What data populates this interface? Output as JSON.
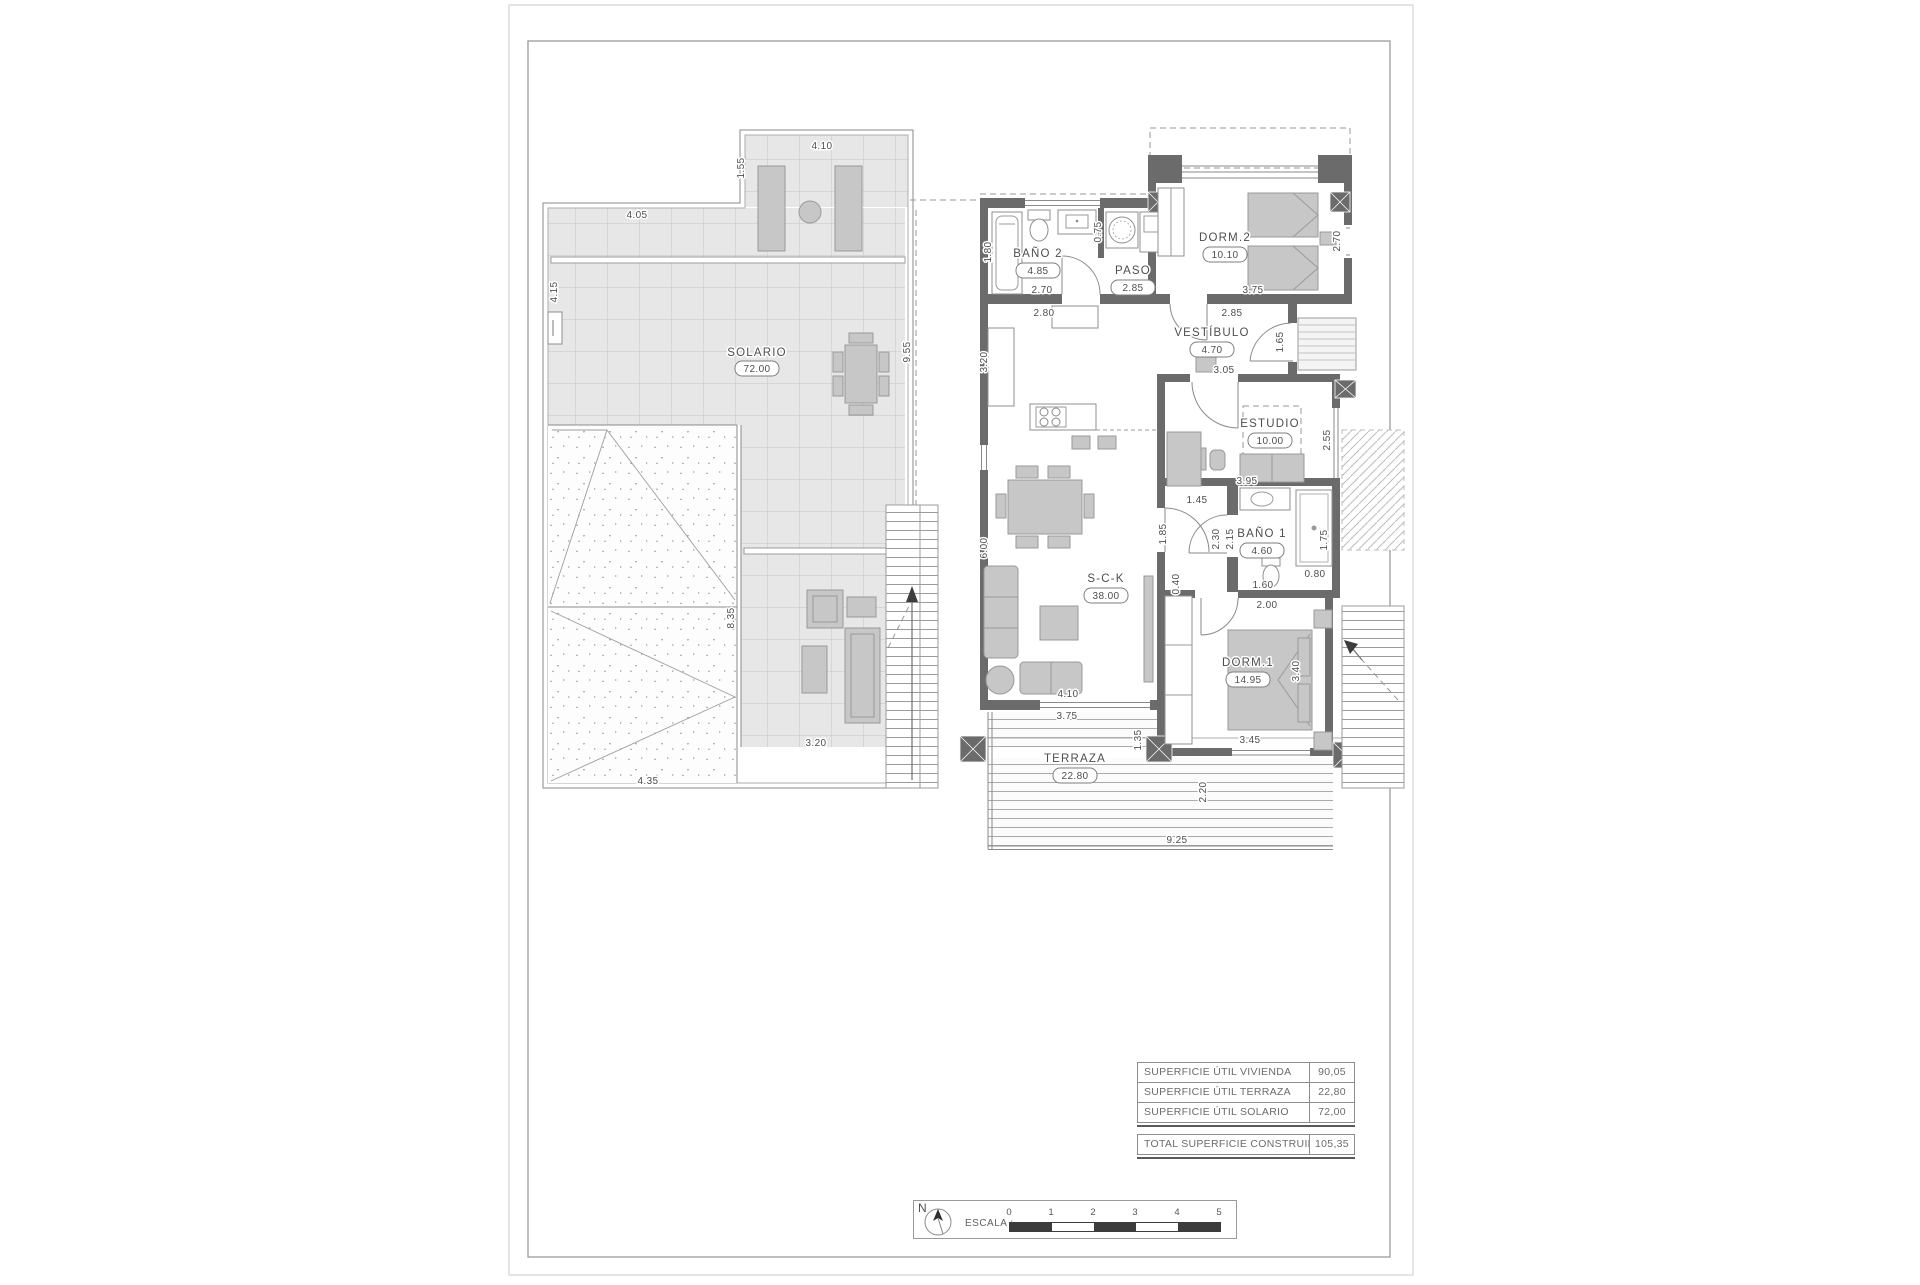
{
  "solarium_plan": {
    "room": {
      "label": "SOLARIO",
      "area": "72.00"
    },
    "dims": {
      "upper_terrace_width": "4.10",
      "upper_terrace_depth": "1.55",
      "top_width": "4.05",
      "left_height": "4.15",
      "right_height": "9.55",
      "roof_height": "8.35",
      "deck_width": "3.20",
      "roof_width": "4.35"
    }
  },
  "floor_plan": {
    "rooms": [
      {
        "label": "BAÑO 2",
        "area": "4.85"
      },
      {
        "label": "PASO",
        "area": "2.85"
      },
      {
        "label": "DORM.2",
        "area": "10.10"
      },
      {
        "label": "VESTÍBULO",
        "area": "4.70"
      },
      {
        "label": "ESTUDIO",
        "area": "10.00"
      },
      {
        "label": "BAÑO 1",
        "area": "4.60"
      },
      {
        "label": "S-C-K",
        "area": "38.00"
      },
      {
        "label": "DORM.1",
        "area": "14.95"
      },
      {
        "label": "TERRAZA",
        "area": "22.80"
      }
    ],
    "dims": {
      "bano2_height": "1.80",
      "bano2_width": "2.70",
      "bano2_width_total": "2.80",
      "paso_niche": "0.75",
      "dorm2_width": "3.75",
      "dorm2_width_wall": "2.85",
      "dorm2_window": "2.70",
      "entrance_door": "1.65",
      "vestibulo_width": "3.05",
      "estudio_window": "2.55",
      "estudio_width": "3.95",
      "hall_width": "1.45",
      "sck_door": "1.85",
      "hall_len_a": "2.30",
      "hall_len_b": "2.15",
      "shower_len": "1.75",
      "shower_width": "0.80",
      "bano1_width": "1.60",
      "bano1_width_total": "2.00",
      "kitchen_wall": "3.20",
      "living_height": "6.00",
      "closet_depth": "0.40",
      "sck_window": "4.10",
      "terraza_window": "3.75",
      "terraza_side": "1.35",
      "dorm1_window": "3.45",
      "dorm1_height": "3.40",
      "terraza_depth": "2.20",
      "terraza_width": "9.25"
    }
  },
  "summary_table": {
    "rows": [
      {
        "label": "SUPERFICIE ÚTIL VIVIENDA",
        "value": "90,05"
      },
      {
        "label": "SUPERFICIE ÚTIL TERRAZA",
        "value": "22,80"
      },
      {
        "label": "SUPERFICIE ÚTIL SOLARIO",
        "value": "72,00"
      }
    ],
    "total": {
      "label": "TOTAL SUPERFICIE CONSTRUIDA",
      "value": "105,35"
    }
  },
  "scale_bar": {
    "north_label": "N",
    "label": "ESCALA :",
    "ticks": [
      "0",
      "1",
      "2",
      "3",
      "4",
      "5"
    ]
  }
}
